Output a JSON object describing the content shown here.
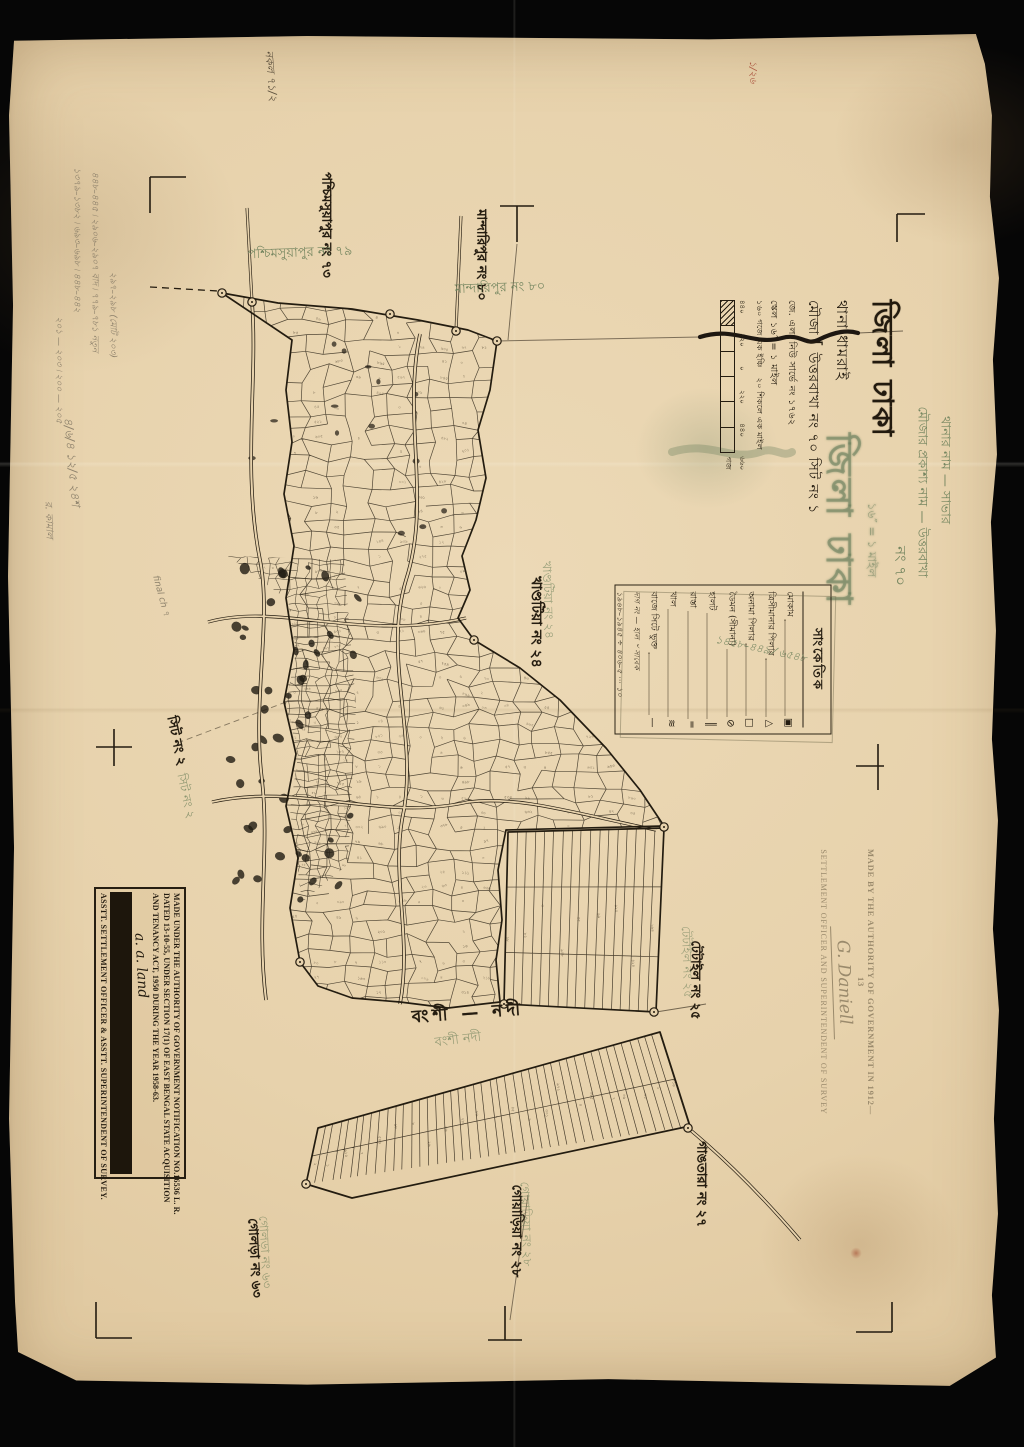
{
  "title_block": {
    "district_line": "জিলা ঢাকা",
    "thana_line": "থানা ধামরাই",
    "mouza_prefix": "মৌজা",
    "mouza_value": "উত্তরবাখা নং ৭০ সিট নং ১",
    "survey_line": "জে. এল. নিউ সার্ভে নং ১৭৬২",
    "scale_line": "স্কেল ১৬″ = ১ মাইল",
    "scale_sub1": "১৬০ গজে এক ইঞ্চি",
    "scale_sub2": "২০ শিকলে এক মাইল",
    "scalebar_labels": [
      "৪৪০",
      "২২০",
      "০",
      "২২০",
      "৪৪০",
      "৬৬০"
    ],
    "scalebar_unit": "গজ"
  },
  "green_overprint": {
    "thana_name_line": "থানার নাম — সাভার",
    "mouza_name_line": "মৌজার প্রকাশ্য নাম — উত্তরবাখা",
    "mouza_no_line": "নং ৭০",
    "ghost_title": "জিলা ঢাকা",
    "ghost_scale": "১৬″ = ১ মাইল"
  },
  "legend": {
    "title": "সাংকেতিক",
    "rows": [
      {
        "label": "মোকাম",
        "symbol": "▣"
      },
      {
        "label": "ত্রিসীমানার পিলার",
        "symbol": "△"
      },
      {
        "label": "অনামা পিলার",
        "symbol": "□"
      },
      {
        "label": "ডৈমন (সীমানা)",
        "symbol": "⊘"
      },
      {
        "label": "হালট",
        "symbol": "║"
      },
      {
        "label": "রাস্তা",
        "symbol": "═"
      },
      {
        "label": "খাল",
        "symbol": "≋"
      },
      {
        "label": "বাজে সিটে ভুক্ত",
        "symbol": "—"
      }
    ],
    "green_note": "১৪৫৮–৪৪৯ ⁄ ৬৫৪৮",
    "hand_line1": "দাগ নং — হাল ৺ সাবেক",
    "hand_line2": "১৯৬৮–১৯৪৫ ÷ ৪০৬–৫ ⋯ ১০"
  },
  "stamps": {
    "survey_1912": {
      "line1": "MADE BY THE AUTHORITY OF GOVERNMENT IN 1912—13",
      "signature": "G. Daniell",
      "line2": "SETTLEMENT OFFICER AND SUPERINTENDENT OF SURVEY"
    },
    "settlement": {
      "line1": "MADE UNDER THE AUTHORITY OF GOVERNMENT NOTIFICATION NO.16536 L. R.",
      "line2": "DATED 13-10-55, UNDER SECTION 17(1) OF EAST BENGAL STATE ACQUISITION",
      "line3": "AND TENANCY ACT, 1950 DURING THE YEAR 1958-63.",
      "signature": "a. a. land",
      "footer": "ASSTT. SETTLEMENT OFFICER & ASSTT. SUPERINTENDENT OF SURVEY."
    }
  },
  "map_labels": [
    {
      "id": "w73",
      "text": "পশ্চিমসুয়াপুর নং ৭৩",
      "color": "black"
    },
    {
      "id": "w79g",
      "text": "পশ্চিমসুয়াপুর নং ৭৯",
      "color": "green"
    },
    {
      "id": "n80",
      "text": "মান্দারিপুর নং ৮০",
      "color": "black"
    },
    {
      "id": "n80g",
      "text": "মান্দারিপুর নং ৮০",
      "color": "green"
    },
    {
      "id": "e24",
      "text": "খাণ্ডটিয়া নং ২৪",
      "color": "black"
    },
    {
      "id": "e24g",
      "text": "খাণ্ডটিয়া নং ২৪",
      "color": "green"
    },
    {
      "id": "sit2",
      "text": "সিট নং ২",
      "color": "black"
    },
    {
      "id": "sit2g",
      "text": "সিট নং ২",
      "color": "green"
    },
    {
      "id": "t25",
      "text": "টেটাইল নং ২৫",
      "color": "black"
    },
    {
      "id": "t25g",
      "text": "টেটাইল নং ২৫",
      "color": "green"
    },
    {
      "id": "g27",
      "text": "গাঙতারা নং ২৭",
      "color": "black"
    },
    {
      "id": "gy28",
      "text": "গোয়াড়িয়া নং ২৮",
      "color": "black"
    },
    {
      "id": "gy28g",
      "text": "গোয়াড়িয়া নং ২৮",
      "color": "green"
    },
    {
      "id": "gl63",
      "text": "গোলড়া নং ৬৩",
      "color": "black"
    },
    {
      "id": "gl63g",
      "text": "গোলড়া নং ৬৩",
      "color": "green"
    },
    {
      "id": "river",
      "text": "বংশী — নদী",
      "color": "black"
    },
    {
      "id": "riverg",
      "text": "বংশী নদী",
      "color": "green"
    }
  ],
  "margin_notes": [
    {
      "id": "tl1",
      "text": "১৩৭৯–১৩৮২ ৷ ৬৯৩–৬৯৮ ৷ ৪৪৮–৪৪২",
      "color": "pencil"
    },
    {
      "id": "tl2",
      "text": "৪৪৮–৪৪৫ ৷ ২৯০৬–২৯০৭ বাদ ৷ ৭৭৯–৭৮১ নতুন",
      "color": "pencil"
    },
    {
      "id": "tl3",
      "text": "২৯৭–২৯৮ (মোট ২০৩)",
      "color": "pencil"
    },
    {
      "id": "l1",
      "text": "২০১ — ২০৩ ৷ ২০০ — ২০৫",
      "color": "pencil"
    },
    {
      "id": "l2",
      "text": "৪/৬/৪  ১২/৫  ২৪শ",
      "color": "pencil"
    },
    {
      "id": "l3",
      "text": "র. কামাল",
      "color": "pencil"
    },
    {
      "id": "l4",
      "text": "final ch ৭",
      "color": "pencil"
    },
    {
      "id": "topred",
      "text": "১/২৬",
      "color": "red"
    },
    {
      "id": "topblk",
      "text": "নকল ৭১/২",
      "color": "ink"
    }
  ]
}
